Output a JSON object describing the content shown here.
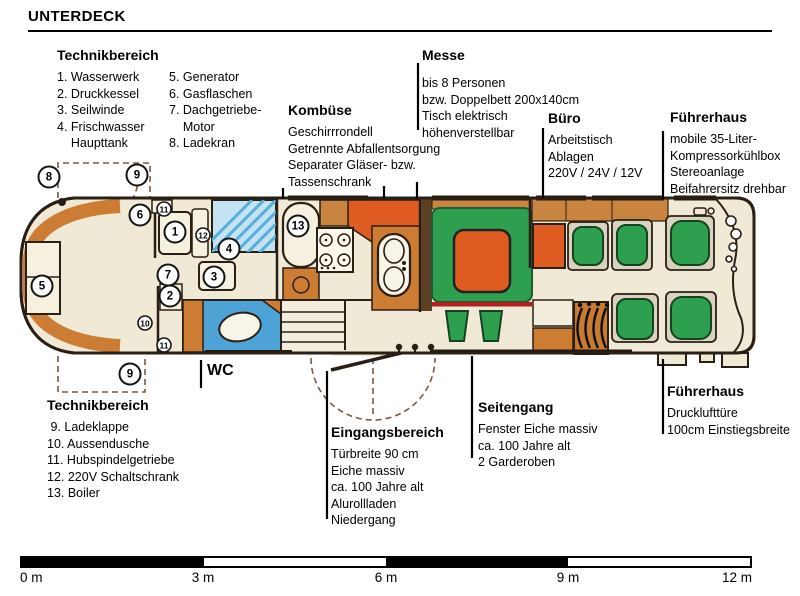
{
  "page": {
    "title": "UNTERDECK"
  },
  "labels": {
    "tech_top": {
      "title": "Technikbereich",
      "col1": [
        "1. Wasserwerk",
        "2. Druckkessel",
        "3. Seilwinde",
        "4. Frischwasser",
        "    Haupttank"
      ],
      "col2": [
        "5. Generator",
        "6. Gasflaschen",
        "7. Dachgetriebe-",
        "    Motor",
        "8. Ladekran"
      ]
    },
    "kombuese": {
      "title": "Kombüse",
      "lines": [
        "Geschirrrondell",
        "Getrennte Abfallentsorgung",
        "Separater Gläser- bzw.",
        "Tassenschrank"
      ]
    },
    "messe": {
      "title": "Messe",
      "lines": [
        "bis 8 Personen",
        "bzw. Doppelbett 200x140cm",
        "Tisch elektrisch",
        "höhenverstellbar"
      ]
    },
    "buero": {
      "title": "Büro",
      "lines": [
        "Arbeitstisch",
        "Ablagen",
        "220V / 24V / 12V"
      ]
    },
    "fuehrerhaus_top": {
      "title": "Führerhaus",
      "lines": [
        "mobile 35-Liter-",
        "Kompressorkühlbox",
        "Stereoanlage",
        "Beifahrersitz drehbar"
      ]
    },
    "fuehrerhaus_bottom": {
      "title": "Führerhaus",
      "lines": [
        "Drucklufttüre",
        "100cm Einstiegsbreite"
      ]
    },
    "seitengang": {
      "title": "Seitengang",
      "lines": [
        "Fenster Eiche massiv",
        "ca. 100 Jahre alt",
        "2 Garderoben"
      ]
    },
    "eingangsbereich": {
      "title": "Eingangsbereich",
      "lines": [
        "Türbreite 90 cm",
        "Eiche massiv",
        "ca. 100 Jahre alt",
        "Alurollladen",
        "Niedergang"
      ]
    },
    "tech_bottom": {
      "title": "Technikbereich",
      "items": [
        " 9. Ladeklappe",
        "10. Aussendusche",
        "11. Hubspindelgetriebe",
        "12. 220V Schaltschrank",
        "13. Boiler"
      ]
    },
    "wc": "WC"
  },
  "plan": {
    "badges": [
      {
        "n": "8",
        "x": 49,
        "y": 177,
        "s": "lg"
      },
      {
        "n": "9",
        "x": 137,
        "y": 175,
        "s": "lg"
      },
      {
        "n": "6",
        "x": 140,
        "y": 215,
        "s": "lg"
      },
      {
        "n": "11",
        "x": 164,
        "y": 209,
        "s": "sm"
      },
      {
        "n": "1",
        "x": 175,
        "y": 232,
        "s": "lg"
      },
      {
        "n": "12",
        "x": 203,
        "y": 235,
        "s": "sm"
      },
      {
        "n": "4",
        "x": 229,
        "y": 249,
        "s": "lg"
      },
      {
        "n": "5",
        "x": 42,
        "y": 286,
        "s": "lg"
      },
      {
        "n": "7",
        "x": 168,
        "y": 275,
        "s": "lg"
      },
      {
        "n": "3",
        "x": 214,
        "y": 277,
        "s": "lg"
      },
      {
        "n": "2",
        "x": 170,
        "y": 296,
        "s": "lg"
      },
      {
        "n": "10",
        "x": 145,
        "y": 323,
        "s": "sm"
      },
      {
        "n": "11",
        "x": 164,
        "y": 345,
        "s": "sm"
      },
      {
        "n": "9",
        "x": 130,
        "y": 374,
        "s": "lg"
      },
      {
        "n": "13",
        "x": 298,
        "y": 226,
        "s": "lg"
      }
    ]
  },
  "scale": {
    "labels": [
      "0 m",
      "3 m",
      "6 m",
      "9 m",
      "12 m"
    ]
  },
  "colors": {
    "hull_cream": "#F0E9D5",
    "accent_orange": "#CC7D33",
    "wood": "#C98440",
    "red_orange": "#DE5B22",
    "seat_green": "#2E9E4F",
    "bath_blue": "#4EA3D6",
    "tank_blue": "#C3E2F2",
    "red_line": "#B22020"
  }
}
